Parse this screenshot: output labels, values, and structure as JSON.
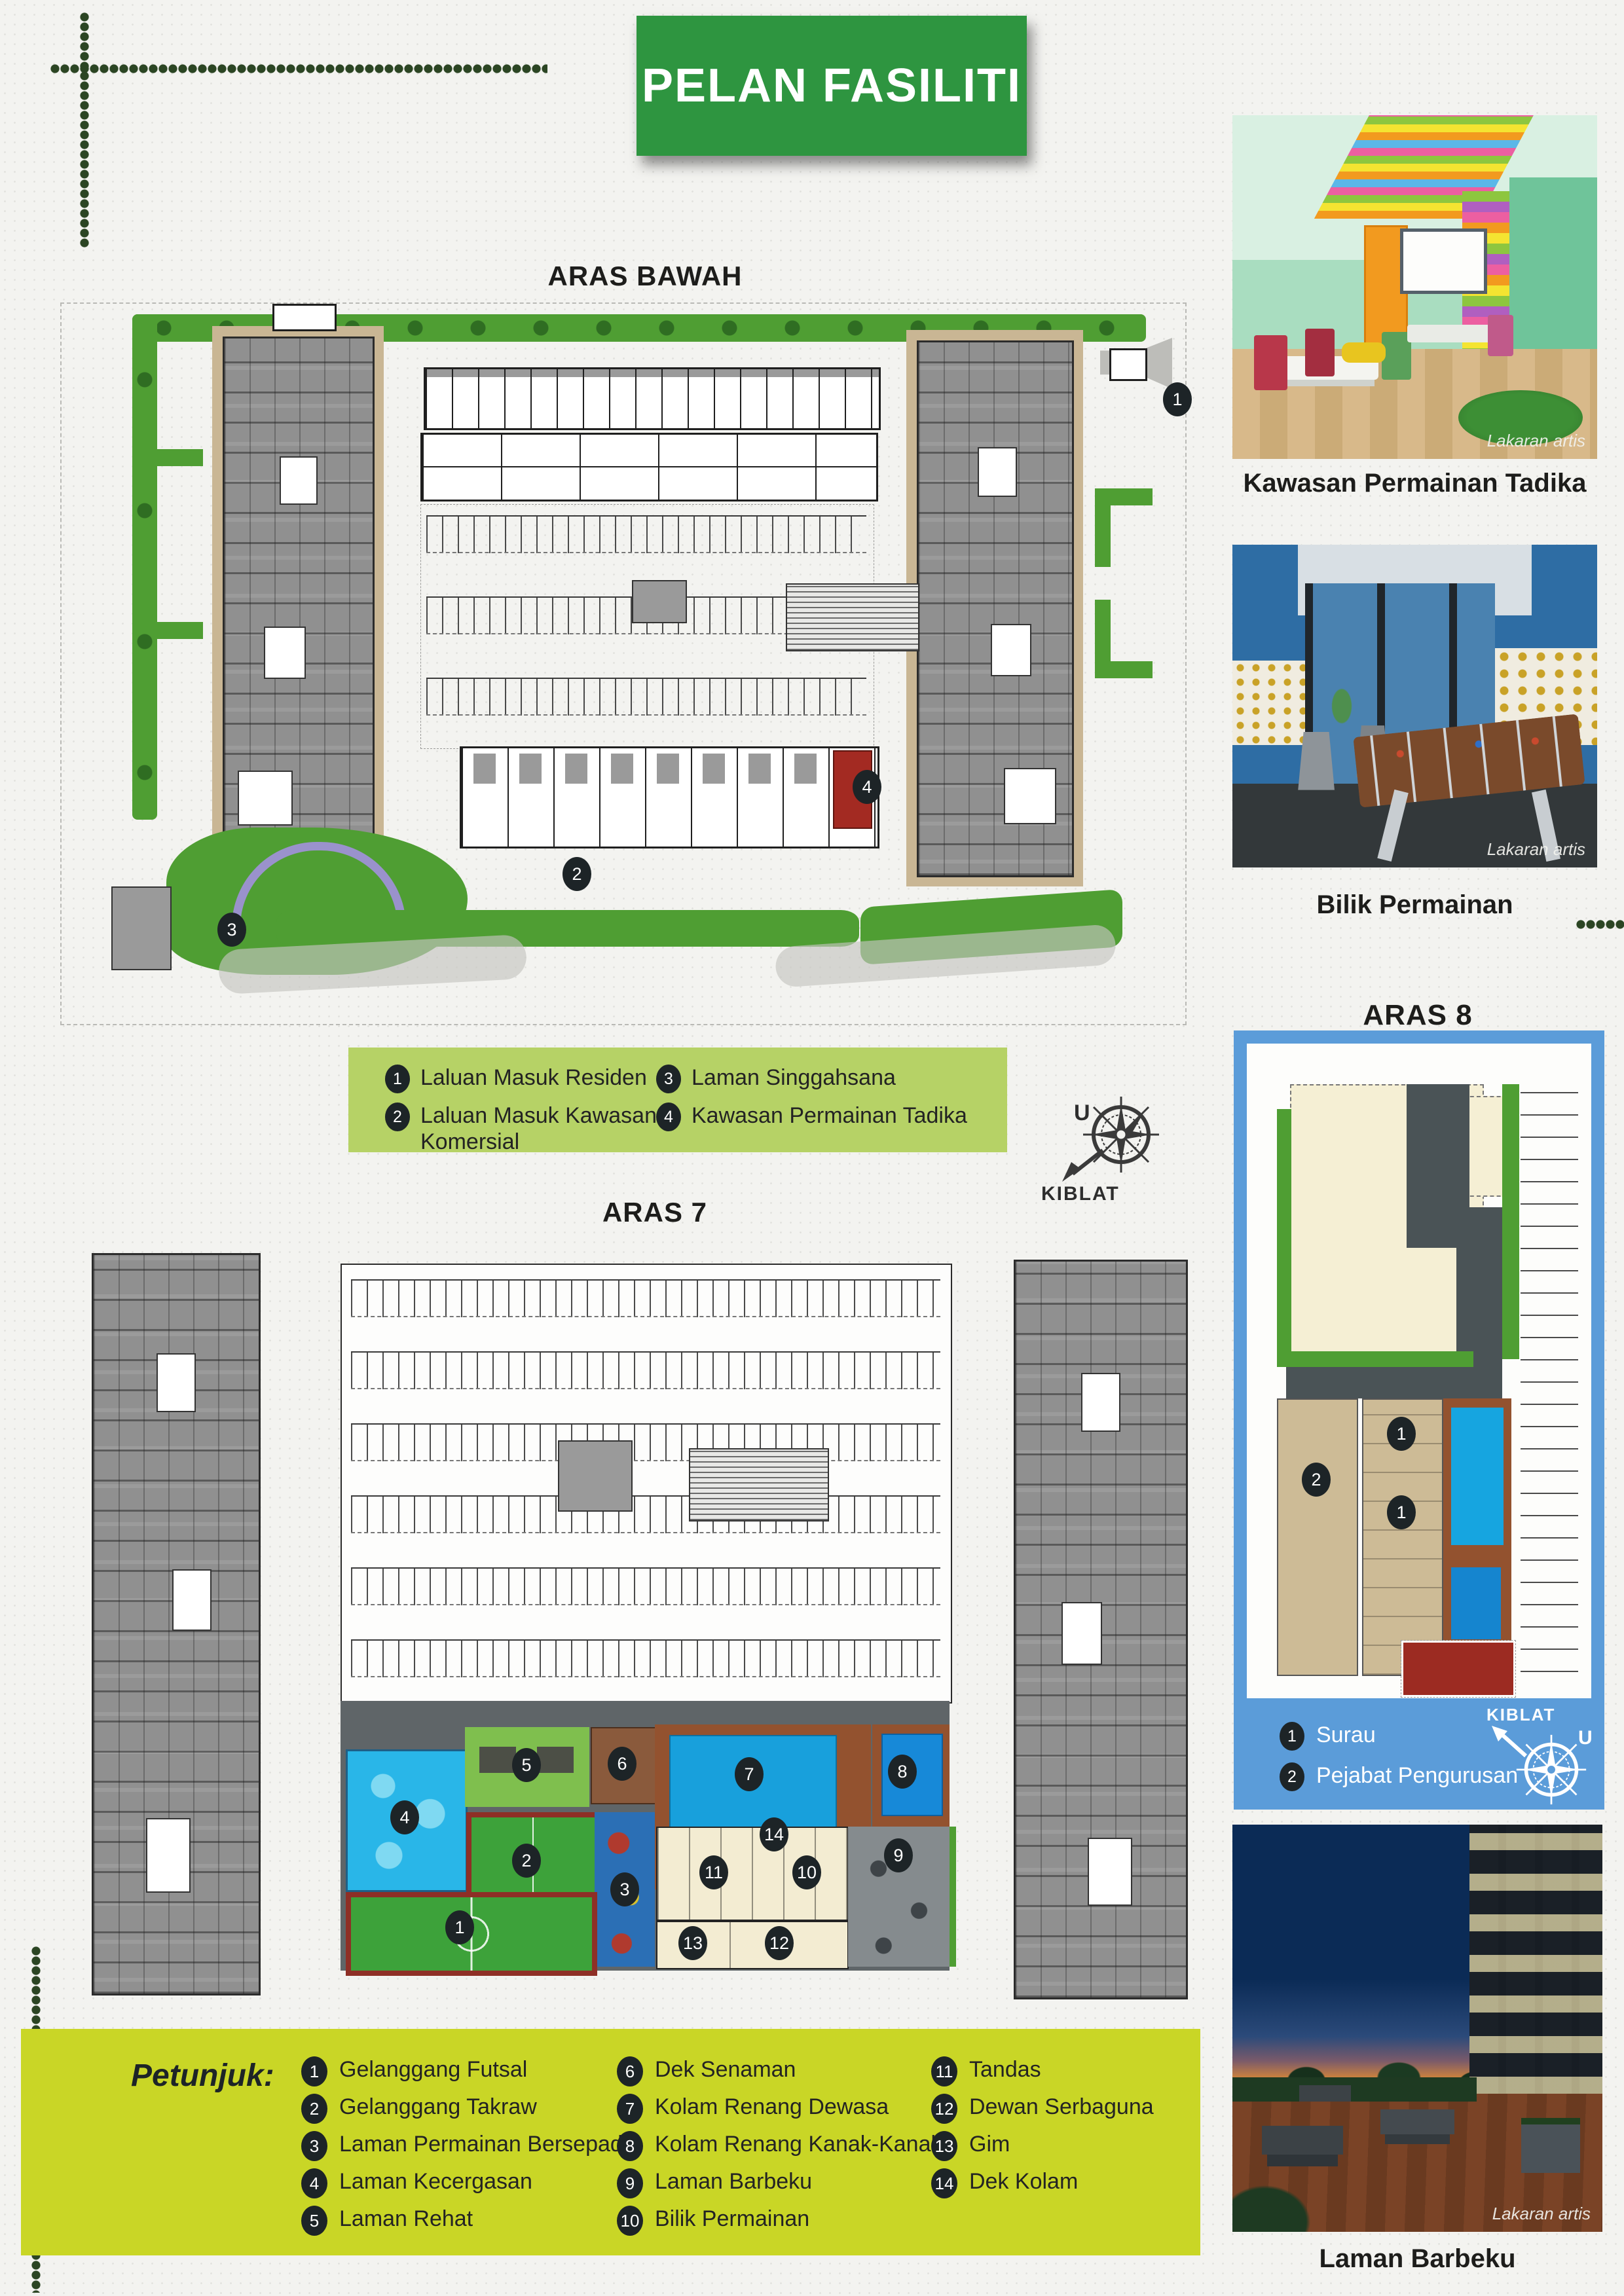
{
  "page": {
    "title": "PELAN FASILITI"
  },
  "aras_bawah": {
    "heading": "ARAS BAWAH",
    "legend": {
      "items": [
        {
          "num": "1",
          "label": "Laluan Masuk Residen"
        },
        {
          "num": "2",
          "label": "Laluan Masuk Kawasan Komersial"
        },
        {
          "num": "3",
          "label": "Laman Singgahsana"
        },
        {
          "num": "4",
          "label": "Kawasan Permainan Tadika"
        }
      ]
    },
    "compass": {
      "north": "U",
      "qibla": "KIBLAT"
    }
  },
  "aras7": {
    "heading": "ARAS 7"
  },
  "aras8": {
    "heading": "ARAS 8",
    "legend": {
      "items": [
        {
          "num": "1",
          "label": "Surau"
        },
        {
          "num": "2",
          "label": "Pejabat Pengurusan"
        }
      ]
    },
    "compass": {
      "north": "U",
      "qibla": "KIBLAT"
    }
  },
  "photos": [
    {
      "caption": "Kawasan Permainan Tadika",
      "watermark": "Lakaran artis"
    },
    {
      "caption": "Bilik Permainan",
      "watermark": "Lakaran artis"
    },
    {
      "caption": "Laman Barbeku",
      "watermark": "Lakaran artis"
    }
  ],
  "petunjuk": {
    "heading": "Petunjuk:",
    "items": [
      {
        "num": "1",
        "label": "Gelanggang Futsal"
      },
      {
        "num": "2",
        "label": "Gelanggang Takraw"
      },
      {
        "num": "3",
        "label": "Laman Permainan Bersepadu"
      },
      {
        "num": "4",
        "label": "Laman Kecergasan"
      },
      {
        "num": "5",
        "label": "Laman Rehat"
      },
      {
        "num": "6",
        "label": "Dek Senaman"
      },
      {
        "num": "7",
        "label": "Kolam Renang Dewasa"
      },
      {
        "num": "8",
        "label": "Kolam Renang Kanak-Kanak"
      },
      {
        "num": "9",
        "label": "Laman Barbeku"
      },
      {
        "num": "10",
        "label": "Bilik Permainan"
      },
      {
        "num": "11",
        "label": "Tandas"
      },
      {
        "num": "12",
        "label": "Dewan Serbaguna"
      },
      {
        "num": "13",
        "label": "Gim"
      },
      {
        "num": "14",
        "label": "Dek Kolam"
      }
    ]
  },
  "colors": {
    "brand_green": "#2e9540",
    "legend_green": "#b6d266",
    "petunjuk_green": "#c9d626",
    "aras8_blue": "#5b9cd9",
    "pool_blue": "#18a0dc"
  }
}
